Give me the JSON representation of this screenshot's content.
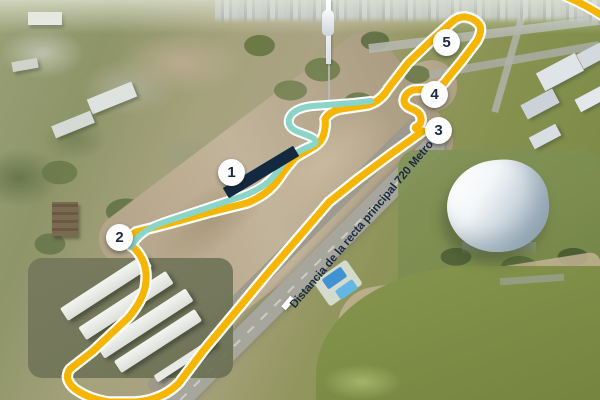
{
  "map": {
    "straight_label": "Distancia de la recta principal 720 Metros",
    "markers": [
      {
        "label": "1"
      },
      {
        "label": "2"
      },
      {
        "label": "3"
      },
      {
        "label": "4"
      },
      {
        "label": "5"
      }
    ],
    "colors": {
      "track_yellow": "#F6B500",
      "track_casing_white": "#FFFFFF",
      "sector_teal": "#8AD4C8",
      "pit_building_navy": "#13293F",
      "marker_text_navy": "#1B2A44",
      "label_text_navy": "#1B2A44",
      "label_bg_white": "#FFFFFF",
      "lake_green": "#7E8D46",
      "dirt_tan": "#B7A88C"
    }
  }
}
